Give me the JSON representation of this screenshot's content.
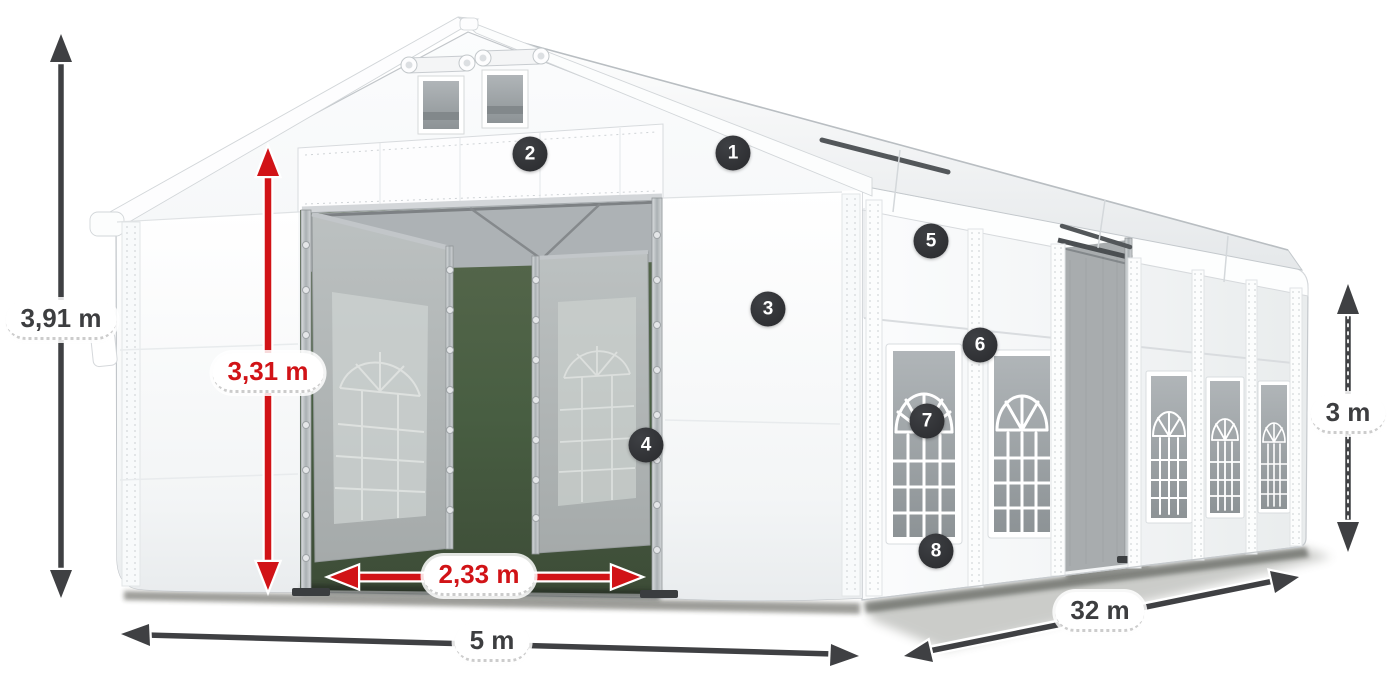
{
  "diagram": {
    "kind": "tent-dimension-diagram"
  },
  "dimensions": {
    "total_height": {
      "label": "3,91 m",
      "color": "dark"
    },
    "entrance_height": {
      "label": "3,31 m",
      "color": "red"
    },
    "entrance_width": {
      "label": "2,33 m",
      "color": "red"
    },
    "front_width": {
      "label": "5 m",
      "color": "dark"
    },
    "side_length": {
      "label": "32 m",
      "color": "dark"
    },
    "side_height": {
      "label": "3 m",
      "color": "dark"
    }
  },
  "callouts": [
    {
      "number": "1"
    },
    {
      "number": "2"
    },
    {
      "number": "3"
    },
    {
      "number": "4"
    },
    {
      "number": "5"
    },
    {
      "number": "6"
    },
    {
      "number": "7"
    },
    {
      "number": "8"
    }
  ],
  "icons": {
    "vertical_double_arrow": "↕",
    "horizontal_double_arrow": "↔",
    "diagonal_double_arrow": "⤢"
  },
  "colors": {
    "dimension_red": "#d11317",
    "dimension_dark": "#3f4043",
    "callout_badge_bg": "#303134",
    "label_background": "#ffffff",
    "doorway_interior": "#485e42"
  }
}
